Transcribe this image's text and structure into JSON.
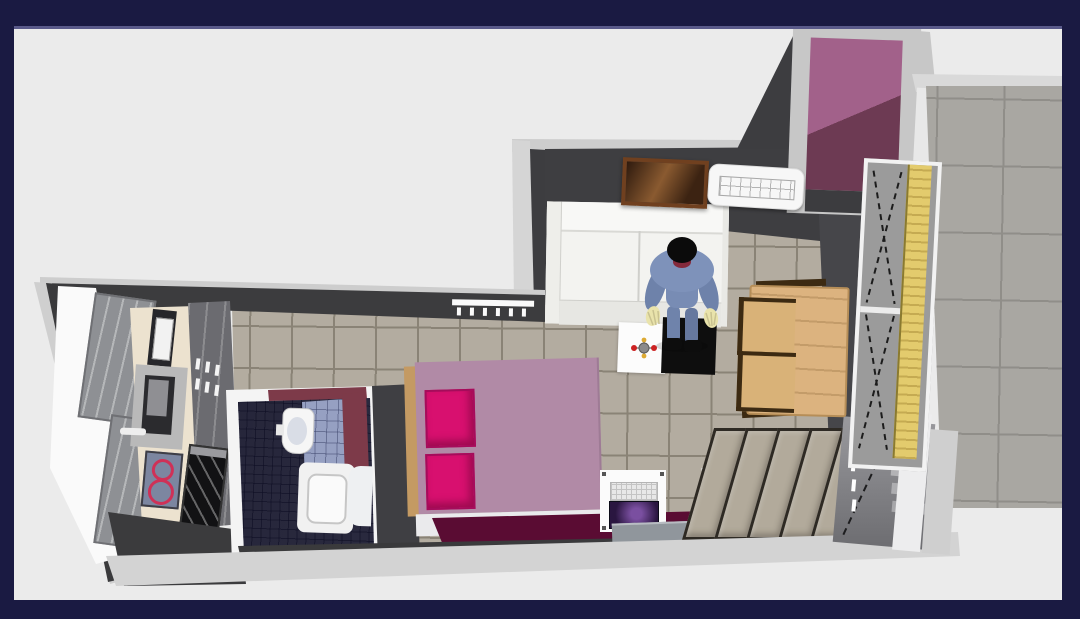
{
  "frame": {
    "border_color": "#1a1a42",
    "inner_line_color": "#5a5a8a",
    "canvas_background": "#ebebeb"
  },
  "scene": {
    "label": "Aerial 3D rendering of a studio apartment floor plan",
    "view": "top-down 3D home-design render, no visible text",
    "walls": {
      "top_edge_color": "#cdcdcd",
      "face_color": "#3d3d40",
      "exterior_band_color": "#d3d3d3",
      "interior_white_color": "#fafafa"
    },
    "rooms": {
      "living": {
        "label": "Living room",
        "floor": "beige ceramic tile",
        "floor_color": "#b3aca0",
        "grout_color": "#8a8376"
      },
      "bedroom": {
        "label": "Bedroom area",
        "floor": "beige ceramic tile",
        "floor_color": "#b3aca0"
      },
      "kitchen": {
        "label": "Kitchen",
        "floor_color": "#3b3b3d",
        "counter_color": "#ece2cf"
      },
      "bathroom": {
        "label": "Bathroom",
        "floor": "navy mosaic tile",
        "floor_color": "#2e2e44",
        "glass_block_wall_color": "#96a0c2",
        "plum_wall_color": "#7d3a49"
      },
      "entry": {
        "label": "Entrance hall",
        "floor_color_lit": "#a2618a",
        "floor_color_shadow": "#6d3a53"
      },
      "balcony": {
        "label": "Balcony terrace",
        "floor": "large concrete tile",
        "floor_color": "#a9a7a2"
      }
    },
    "items": {
      "sofa": {
        "label": "White sofa",
        "color": "#f3f3f0"
      },
      "picture": {
        "label": "Framed wall picture",
        "frame_color": "#70401f"
      },
      "ac": {
        "label": "Air conditioner unit",
        "color": "#f7f7f7"
      },
      "radiator_living": {
        "label": "Wall radiator",
        "color": "#fafafa"
      },
      "person": {
        "label": "Person figure bending over",
        "suit_color": "#7e92ba",
        "hands_color": "#e9e3ab"
      },
      "coffee_table": {
        "label": "Black coffee table",
        "color": "#0e0e0e"
      },
      "white_rug": {
        "label": "White rug",
        "color": "#fcfcfc"
      },
      "toy": {
        "label": "Small colorful toy on rug",
        "colors": [
          "#8a8a8a",
          "#cc2222",
          "#ddaa33"
        ]
      },
      "dining_table": {
        "label": "Wooden dining table",
        "color": "#dcb37f"
      },
      "chair1": {
        "label": "Dining chair",
        "color": "#d9b278"
      },
      "chair2": {
        "label": "Dining chair",
        "color": "#d9b278"
      },
      "window": {
        "label": "Balcony window with yellow roller blind",
        "blind_color": "#e3cb6d"
      },
      "bed": {
        "label": "Double bed with mauve duvet",
        "duvet_color": "#b18aa6",
        "frame_color": "#c49a63"
      },
      "pillow1": {
        "label": "Magenta pillow",
        "color": "#d8106f"
      },
      "pillow2": {
        "label": "Magenta pillow",
        "color": "#d8106f"
      },
      "bed_bench": {
        "label": "White bed-end bench",
        "color": "#eaeaec"
      },
      "desk": {
        "label": "White desk with laptop",
        "color": "#fbfbfb"
      },
      "laptop": {
        "label": "Laptop with purple screen",
        "screen_color": "#6a3b8f"
      },
      "doormat": {
        "label": "Grey floor mat",
        "color": "#90969c"
      },
      "maroon_rug": {
        "label": "Dark magenta runner rug",
        "color": "#5a0c33"
      },
      "wardrobe": {
        "label": "Wardrobe with slanted panel doors",
        "panel_color": "#b2aa9b"
      },
      "entry_door": {
        "label": "Glazed door with opening marks",
        "color": "#8a8a8e"
      },
      "kitchen_doors": {
        "label": "Grey kitchen tall doors",
        "color": "#8e9094"
      },
      "counter": {
        "label": "Cream kitchen counter",
        "color": "#ece2cf"
      },
      "sink": {
        "label": "Kitchen sink with faucet",
        "color": "#b9b9b9"
      },
      "cooktop": {
        "label": "Induction hob with red rings",
        "color": "#7c86a0",
        "ring_color": "#cf3157"
      },
      "oven": {
        "label": "Black oven",
        "color": "#121214"
      },
      "cabinets": {
        "label": "Grey kitchen cabinets",
        "color": "#6b6b70"
      },
      "radiator_kitchen": {
        "label": "Kitchen radiator",
        "color": "#f4f4f4"
      },
      "appliance": {
        "label": "Small kitchen appliance",
        "color": "#26262a"
      },
      "basin": {
        "label": "Wall-hung bathroom basin",
        "color": "#f6f6f6"
      },
      "shower": {
        "label": "Shower tray",
        "color": "#f1f1f1"
      }
    }
  }
}
